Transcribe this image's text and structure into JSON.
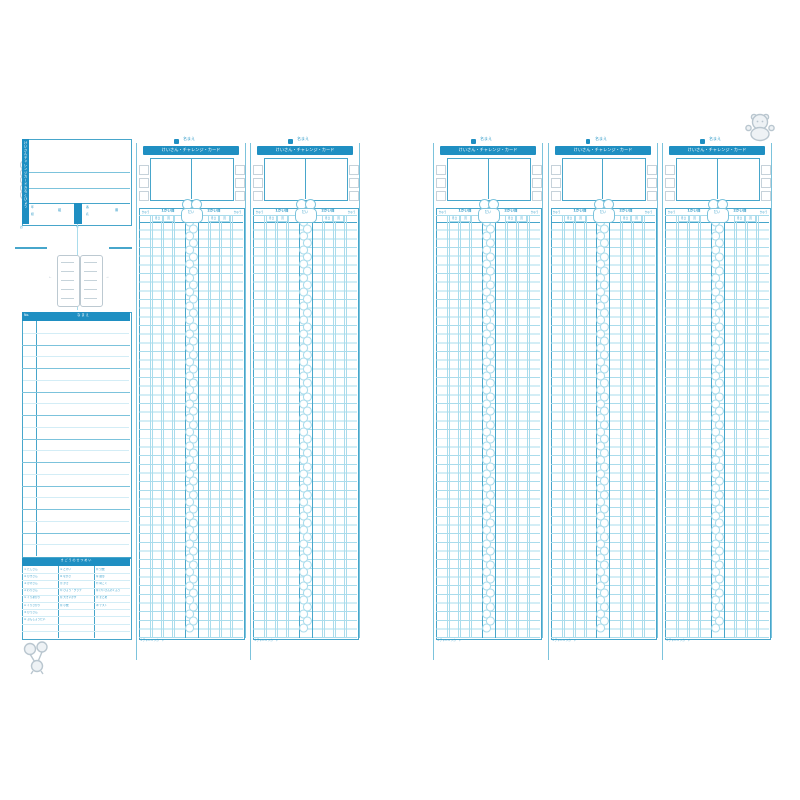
{
  "document_kind": "scanned challenge-card record sheet spread (blue print form)",
  "colors": {
    "bar_blue": "#1f8fc2",
    "line_strong": "#47a6cb",
    "line_mid": "#7cc3dc",
    "line_light": "#aadcec",
    "line_faint": "#d3edf6",
    "text_blue": "#2f9ac8",
    "bubble_gray": "#c6d2da",
    "mascot_gray": "#b9c6cf"
  },
  "left_panel": {
    "vertical_title": "けいさんチャレンジカードきろくひょう",
    "class_row": {
      "left_labels": [
        "年",
        "組"
      ],
      "left_unit": "組",
      "right_labels": [
        "番",
        "名"
      ],
      "right_unit": "番"
    },
    "fold_marks": {
      "left_note": "お",
      "right_note": "り"
    },
    "booklet_illustration": {
      "left_mark": "←",
      "right_mark": "→"
    },
    "roster": {
      "no_header": "No.",
      "name_header": "な ま え",
      "row_count": 10
    },
    "legend": {
      "title": "き ご う の せ つ め い",
      "groups": [
        [
          "① たしざん",
          "② ひきざん",
          "③ かけざん",
          "④ わりざん",
          "⑤ くりあがり",
          "⑥ くりさがり",
          "⑦ ひっさん",
          "⑧ ぶんしょうだい"
        ],
        [
          "⑨ とけい",
          "⑩ ながさ",
          "⑪ かさ",
          "⑫ ひょう・グラフ",
          "⑬ 大きいかず",
          "⑭ 小数"
        ],
        [
          "⑮ 分数",
          "⑯ 図形",
          "⑰ 時こく",
          "⑱ けいさんのくふう",
          "⑲ まとめ",
          "⑳ テスト"
        ]
      ]
    },
    "mascot": "balloon-child-mascot"
  },
  "strip": {
    "count": 5,
    "name_label": "名まえ",
    "title": "けいさん・チャレンジ・カード",
    "level_header": "きゅう",
    "group_left_label": "1かい目",
    "group_right_label": "2かい目",
    "sub_labels": [
      "月日",
      "回"
    ],
    "center_tab_label": "だい",
    "footer_note": "©チャレンジカード",
    "bubble_columns": 4,
    "bubbles_per_column": 5,
    "body_row_count": 48
  },
  "right_page_mascot": "bear-mascot"
}
